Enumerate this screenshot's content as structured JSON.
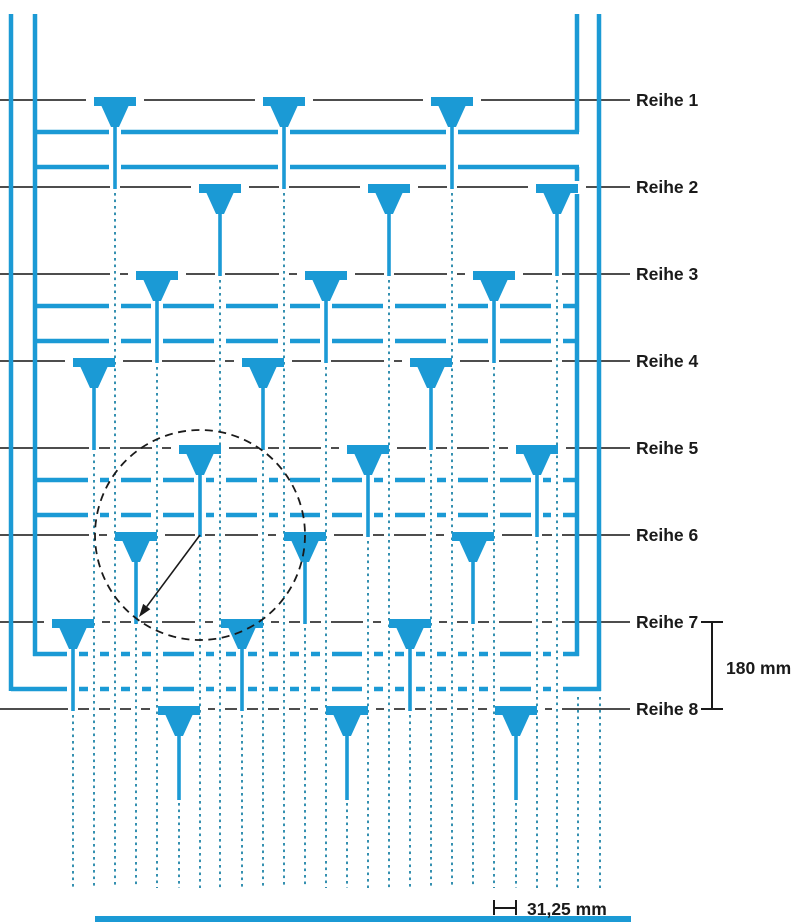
{
  "diagram": {
    "description_labels": {
      "rows": [
        "Reihe 1",
        "Reihe 2",
        "Reihe 3",
        "Reihe 4",
        "Reihe 5",
        "Reihe 6",
        "Reihe 7",
        "Reihe 8"
      ]
    },
    "rows": [
      {
        "label": "Reihe 1",
        "y": 100,
        "nozzles": [
          115,
          284,
          452
        ]
      },
      {
        "label": "Reihe 2",
        "y": 187,
        "nozzles": [
          220,
          389,
          557
        ]
      },
      {
        "label": "Reihe 3",
        "y": 274,
        "nozzles": [
          157,
          326,
          494
        ]
      },
      {
        "label": "Reihe 4",
        "y": 361,
        "nozzles": [
          94,
          263,
          431
        ]
      },
      {
        "label": "Reihe 5",
        "y": 448,
        "nozzles": [
          200,
          368,
          537
        ]
      },
      {
        "label": "Reihe 6",
        "y": 535,
        "nozzles": [
          136,
          305,
          473
        ]
      },
      {
        "label": "Reihe 7",
        "y": 622,
        "nozzles": [
          73,
          242,
          410
        ]
      },
      {
        "label": "Reihe 8",
        "y": 709,
        "nozzles": [
          179,
          347,
          516
        ]
      }
    ],
    "row_label_x": 636,
    "row_line_end_x": 630,
    "jet_bottom_y": 888,
    "piped_gaps": [
      1,
      3,
      5,
      7
    ],
    "supply_lines": [
      {
        "name": "left-outer",
        "x": 11,
        "y1": 14,
        "y2": 691
      },
      {
        "name": "left-inner",
        "x": 35,
        "y1": 14,
        "y2": 656
      },
      {
        "name": "right-inner-top",
        "x": 577,
        "y1": 14,
        "y2": 132
      },
      {
        "name": "right-inner-riser",
        "x": 577,
        "y1": 167,
        "y2": 656,
        "gaps": [
          [
            181,
            194
          ]
        ]
      },
      {
        "name": "right-outer",
        "x": 599,
        "y1": 14,
        "y2": 691
      }
    ],
    "extra_dotted_columns": [
      {
        "x": 578,
        "y1": 697
      },
      {
        "x": 600,
        "y1": 697
      }
    ],
    "annotations": {
      "circle": {
        "cx": 200,
        "cy": 535,
        "r": 105
      },
      "arrow": {
        "x1": 200,
        "y1": 535,
        "x2": 139,
        "y2": 617
      },
      "dim_row_spacing": {
        "label": "180 mm",
        "x": 712,
        "y1": 622,
        "y2": 709,
        "cap_halfwidth": 11,
        "label_x": 726,
        "label_y": 674
      },
      "dim_jet_spacing": {
        "label": "31,25 mm",
        "x1": 494,
        "x2": 516,
        "y": 908,
        "tick_y1": 900,
        "tick_y2": 915,
        "label_x": 527,
        "label_y": 915
      }
    },
    "collector_bar": {
      "x1": 95,
      "x2": 631,
      "y": 916,
      "height": 6
    },
    "colors": {
      "blue": "#1b9ad5",
      "dot": "#3590b0",
      "row_line": "#4d4d4d",
      "ink": "#1a1a1a"
    },
    "nozzle_geometry": {
      "head_w": 42,
      "head_h": 9,
      "taper_top_halfw": 14,
      "taper_bottom_halfw": 4,
      "taper_depth": 27,
      "stem_w": 3.6,
      "row8_stem_end": 800
    }
  }
}
